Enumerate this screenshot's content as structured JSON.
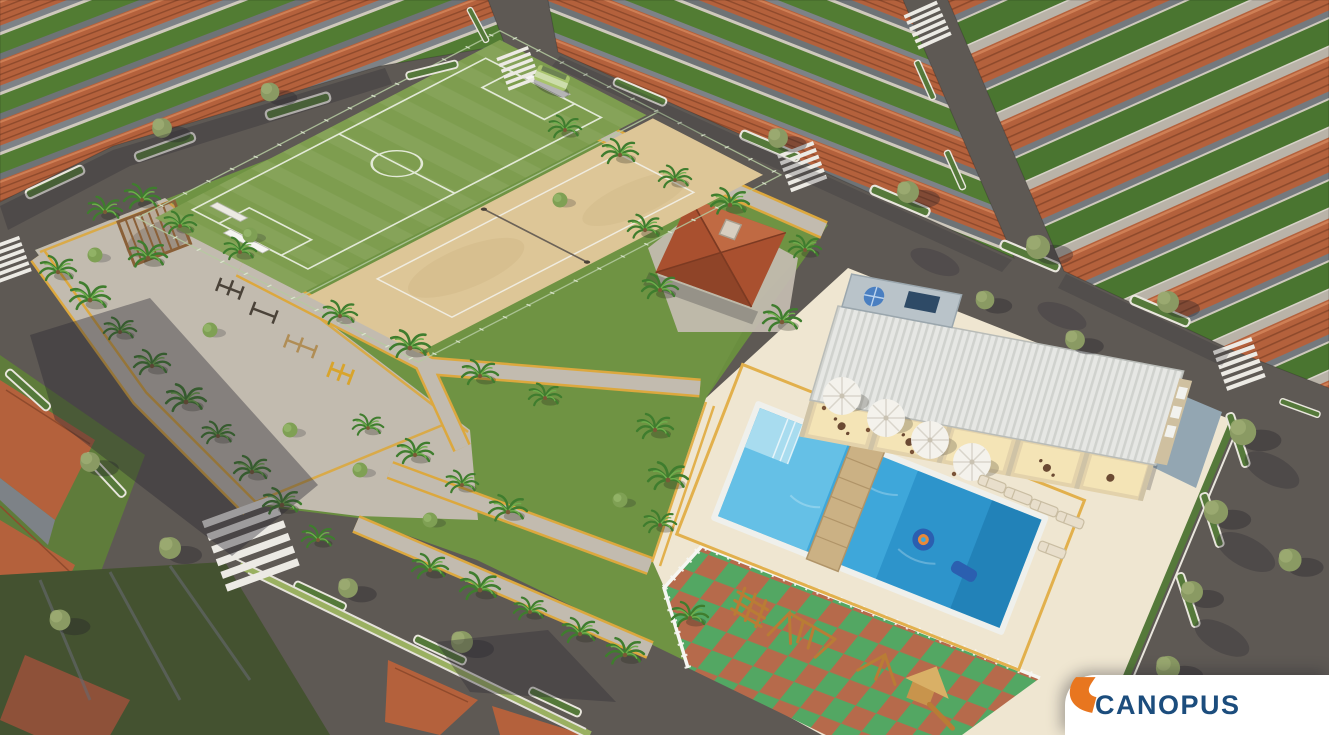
{
  "logo": {
    "text": "CANOPUS",
    "mark": "canopus-orange-l-mark",
    "orange": "#E8761F",
    "navy": "#1C4D7D",
    "card_bg": "#FFFFFF"
  },
  "scene": {
    "type": "aerial-3d-architectural-render",
    "subject": "residential condominium masterplan with central leisure area",
    "amenities": [
      "soccer-field",
      "sand-sports-court",
      "central-park-with-palms",
      "pergola",
      "outdoor-gym",
      "gourmet-gazebo",
      "clubhouse-with-veranda",
      "swimming-pool",
      "pool-wood-bridge",
      "pool-floats",
      "sun-umbrellas",
      "pool-loungers",
      "playground-rubber-checker-floor",
      "walking-paths-yellow-trim"
    ],
    "surroundings": [
      "rows-of-terracotta-roof-houses",
      "asphalt-streets",
      "zebra-crosswalks",
      "green-verges-white-curbs",
      "street-trees",
      "small-shuttle-bus"
    ]
  },
  "palette": {
    "asphalt": "#5E5954",
    "shadow": "#2B2933",
    "sidewalk": "#C2BBAF",
    "lawn": "#6F9343",
    "lawn_dark": "#527C33",
    "field_green": "#7E9D4F",
    "sand": "#DDC697",
    "roof_terracotta": "#B4613C",
    "roof_line": "#8F4A2C",
    "wall_gray": "#7D8287",
    "deck_cream": "#EFE6D1",
    "deck_stripe": "#E2B04C",
    "path_stripe": "#DCA83E",
    "pool_blue": "#3EA7DA",
    "pool_deep": "#1F85C0",
    "pool_light": "#6CC4E8",
    "roof_white": "#E6E7E4",
    "veranda": "#E3D2AB",
    "checker_green": "#53A763",
    "checker_red": "#B66A4B",
    "fence_white": "#F6F6F2",
    "palm": "#3F7D2E",
    "tree": "#8A9A63",
    "verge_green": "#55793A",
    "gazebo_roof": "#A9502F"
  }
}
